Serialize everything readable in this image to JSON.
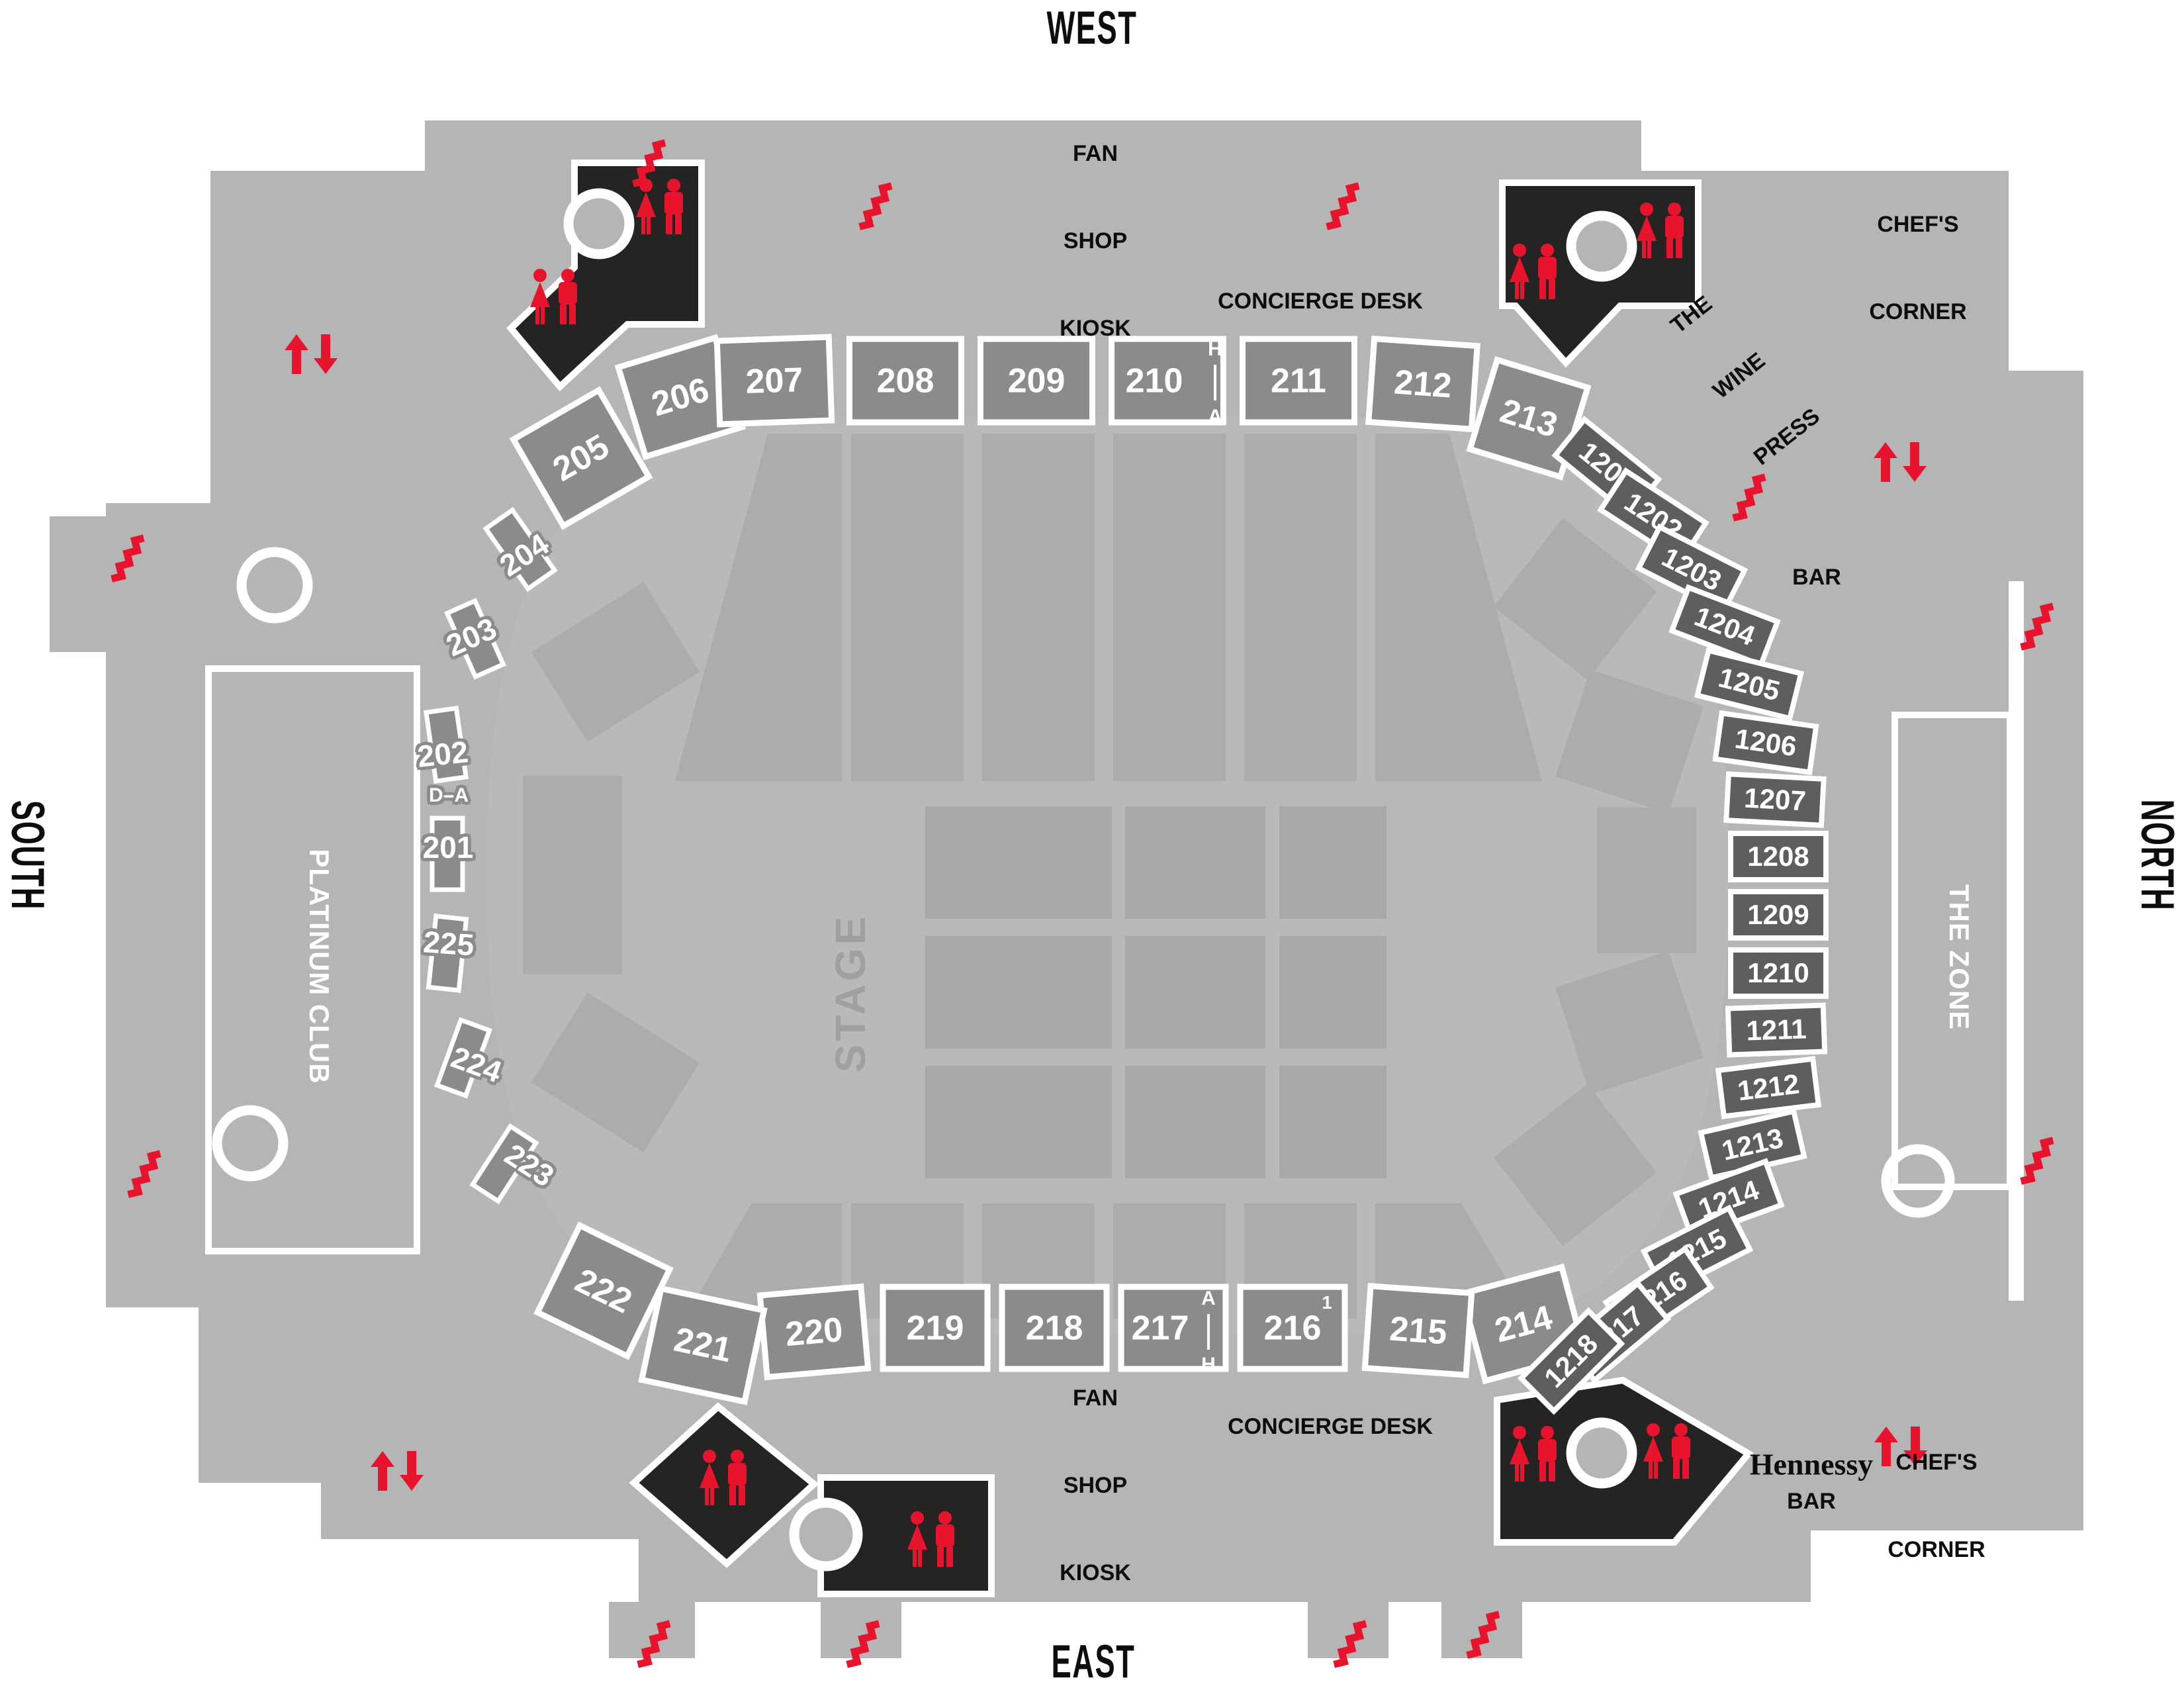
{
  "directions": {
    "west": "WEST",
    "east": "EAST",
    "south": "SOUTH",
    "north": "NORTH"
  },
  "stage": {
    "label": "STAGE"
  },
  "clubs": {
    "platinum": "PLATINUM CLUB",
    "zone": "THE ZONE"
  },
  "amenities": {
    "fan_shop": {
      "l1": "FAN",
      "l2": "SHOP",
      "l3": "KIOSK"
    },
    "concierge": "CONCIERGE DESK",
    "chefs": {
      "l1": "CHEF'S",
      "l2": "CORNER"
    },
    "wine_press": {
      "l1": "THE",
      "l2": "WINE",
      "l3": "PRESS"
    },
    "bar": "BAR",
    "hennessy": {
      "brand": "Hennessy",
      "label": "BAR"
    }
  },
  "sections": {
    "west_200": [
      "205",
      "206",
      "207",
      "208",
      "209",
      "210",
      "211",
      "212",
      "213"
    ],
    "east_200": [
      "214",
      "215",
      "216",
      "217",
      "218",
      "219",
      "220",
      "221",
      "222"
    ],
    "south_200": [
      "204",
      "203",
      "202",
      "201",
      "225",
      "224",
      "223"
    ],
    "north_1200": [
      "1201",
      "1202",
      "1203",
      "1204",
      "1205",
      "1206",
      "1207",
      "1208",
      "1209",
      "1210",
      "1211",
      "1212",
      "1213",
      "1214",
      "1215",
      "1216",
      "1217",
      "1218"
    ]
  },
  "markers": {
    "rows_210": {
      "top": "H",
      "bottom": "A"
    },
    "rows_217": {
      "top": "A",
      "bottom": "H"
    },
    "row_216": "1",
    "rows_201_202": "D–A"
  },
  "icons": {
    "stairs": "stairs-icon",
    "escalator": "escalator-arrows-icon",
    "elevator": "elevator-circle-icon",
    "restroom": "restroom-figures-icon"
  },
  "colors": {
    "concourse": "#b5b5b5",
    "bowl": "#b9b9b9",
    "wedge": "#acacac",
    "floor": "#a8a8a8",
    "section200": "#8b8b8b",
    "section1200": "#5e5e5e",
    "blackBlock": "#262323",
    "red": "#e8142d",
    "ink": "#0d0d0d",
    "white": "#ffffff",
    "stageText": "#a0a0a0"
  }
}
